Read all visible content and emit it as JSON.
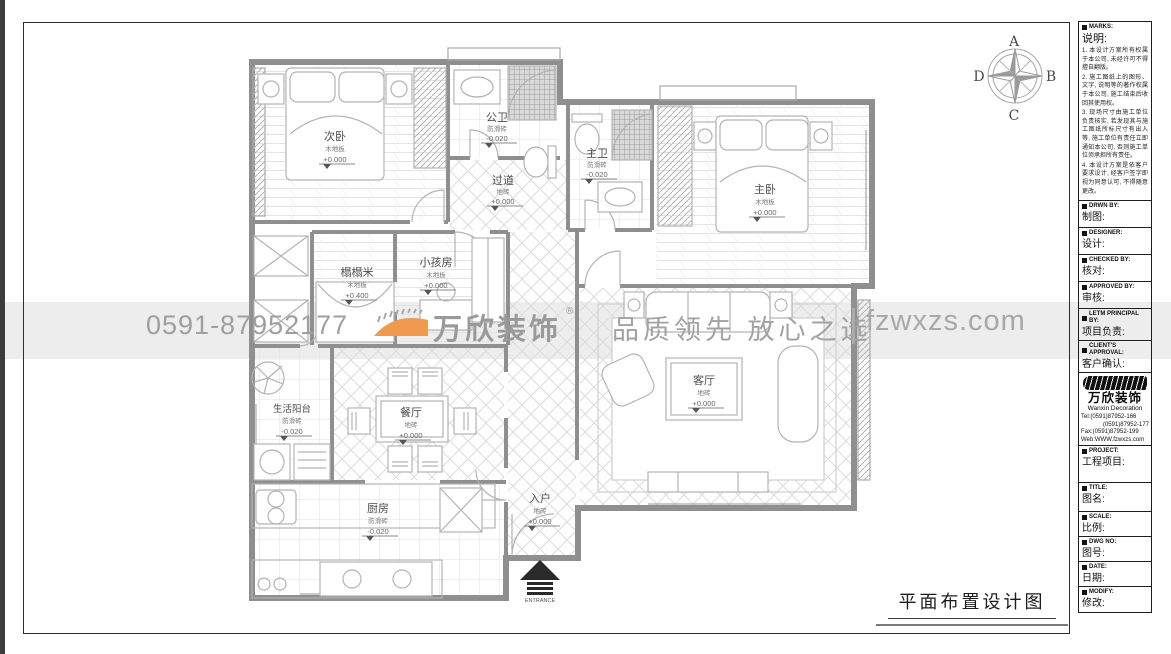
{
  "page": {
    "drawing_title": "平面布置设计图",
    "entrance_label": "ENTRANCE"
  },
  "compass": {
    "north": "A",
    "east": "B",
    "south": "C",
    "west": "D"
  },
  "watermark": {
    "phone": "0591-87952177",
    "brand": "万欣装饰",
    "registered": "®",
    "tagline": "品质领先 放心之选",
    "website": "fzwxzs.com"
  },
  "rooms": [
    {
      "name": "次卧",
      "floor": "木地板",
      "level": "+0.000"
    },
    {
      "name": "公卫",
      "floor": "防滑砖",
      "level": "-0.020"
    },
    {
      "name": "过道",
      "floor": "地砖",
      "level": "+0.000"
    },
    {
      "name": "主卫",
      "floor": "防滑砖",
      "level": "-0.020"
    },
    {
      "name": "主卧",
      "floor": "木地板",
      "level": "+0.000"
    },
    {
      "name": "榻榻米",
      "floor": "木地板",
      "level": "+0.400"
    },
    {
      "name": "小孩房",
      "floor": "木地板",
      "level": "+0.000"
    },
    {
      "name": "客厅",
      "floor": "地砖",
      "level": "+0.000"
    },
    {
      "name": "生活阳台",
      "floor": "防滑砖",
      "level": "-0.020"
    },
    {
      "name": "餐厅",
      "floor": "地砖",
      "level": "+0.000"
    },
    {
      "name": "厨房",
      "floor": "防滑砖",
      "level": "-0.020"
    },
    {
      "name": "入户",
      "floor": "地砖",
      "level": "+0.000"
    }
  ],
  "sidebar": {
    "marks": {
      "en": "MARKS:",
      "zh": "说明:",
      "notes": [
        "1. 本设计方案所有权属于本公司, 未经许可不得擅自翻版。",
        "2. 施工图纸上的图形、文字, 说明等的著作权属于本公司, 施工结束后收回其使用权。",
        "3. 现场尺寸由施工单位负责核实, 若发现其与施工图纸所标尺寸有出入等, 施工单位有责任立即通知本公司, 否则施工单位须承担所有责任。",
        "4. 本设计方案是依客户要求设计, 经客户签字即视为同意认可, 不得随意更改。"
      ]
    },
    "fields": [
      {
        "en": "DRWN BY:",
        "zh": "制图:"
      },
      {
        "en": "DESIGNER:",
        "zh": "设计:"
      },
      {
        "en": "CHECKED BY:",
        "zh": "核对:"
      },
      {
        "en": "APPROVED BY:",
        "zh": "审核:"
      },
      {
        "en": "LETM PRINCIPAL BY:",
        "zh": "项目负责:"
      },
      {
        "en": "CLIENT'S APPROVAL:",
        "zh": "客户确认:"
      },
      {
        "en": "PROJECT:",
        "zh": "工程项目:"
      },
      {
        "en": "TITLE:",
        "zh": "图名:"
      },
      {
        "en": "SCALE:",
        "zh": "比例:"
      },
      {
        "en": "DWG NO:",
        "zh": "图号:"
      },
      {
        "en": "DATE:",
        "zh": "日期:"
      },
      {
        "en": "MODIFY:",
        "zh": "修改:"
      }
    ],
    "company": {
      "brand": "万欣装饰",
      "brand_en": "Wanxin Decoration",
      "tel1": "Tel:(0591)87952-166",
      "tel2": "(0591)87952-177",
      "fax": "Fax:(0591)87952-199",
      "web": "Web:WWW.fzwxzs.com"
    }
  }
}
